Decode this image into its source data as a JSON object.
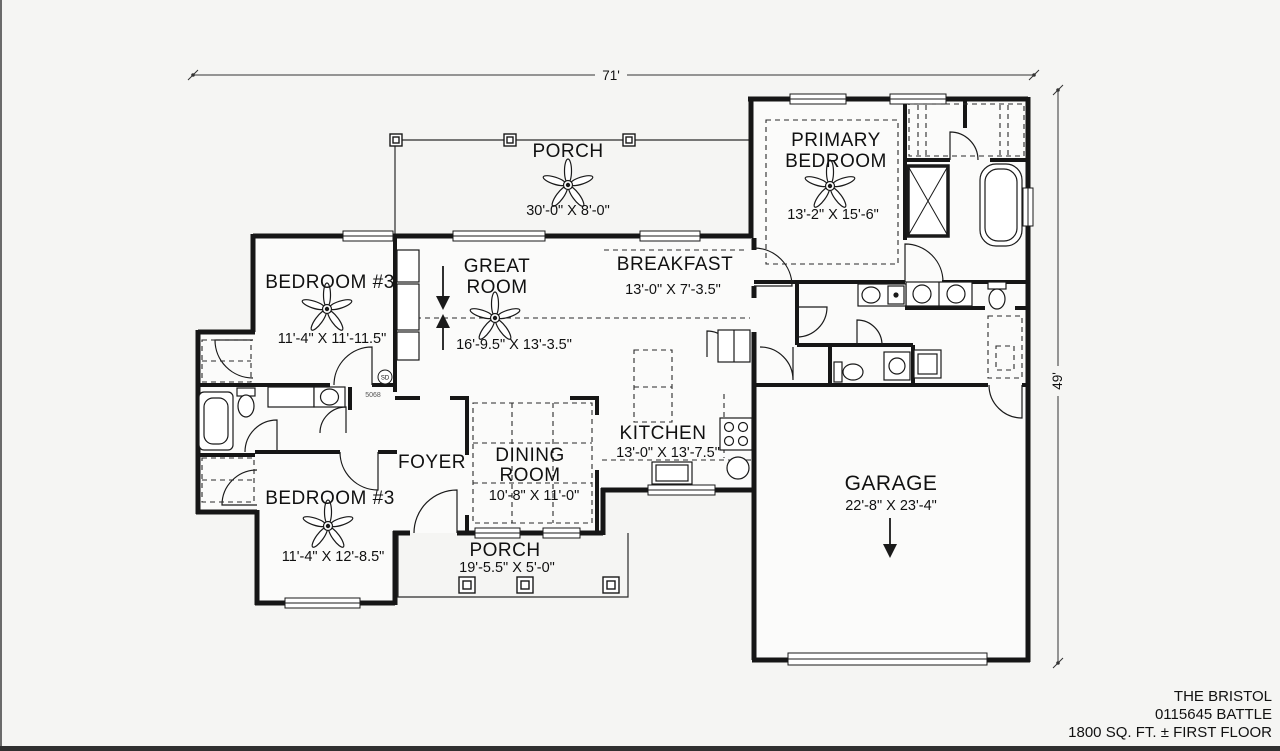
{
  "page": {
    "background": "#f5f5f3",
    "ink": "#1a1a1a"
  },
  "dimension_labels": {
    "top": "71'",
    "right": "49'"
  },
  "rooms": {
    "porch_top": {
      "name": "PORCH",
      "dims": "30'-0\" X 8'-0\""
    },
    "primary_bedroom": {
      "name1": "PRIMARY",
      "name2": "BEDROOM",
      "dims": "13'-2\" X 15'-6\""
    },
    "bedroom3_top": {
      "name": "BEDROOM #3",
      "dims": "11'-4\" X 11'-11.5\""
    },
    "great_room": {
      "name1": "GREAT",
      "name2": "ROOM",
      "dims": "16'-9.5\" X 13'-3.5\""
    },
    "breakfast": {
      "name": "BREAKFAST",
      "dims": "13'-0\" X 7'-3.5\""
    },
    "kitchen": {
      "name": "KITCHEN",
      "dims": "13'-0\" X 13'-7.5\""
    },
    "foyer": {
      "name": "FOYER"
    },
    "dining_room": {
      "name1": "DINING",
      "name2": "ROOM",
      "dims": "10'-8\" X 11'-0\""
    },
    "bedroom3_bottom": {
      "name": "BEDROOM #3",
      "dims": "11'-4\" X 12'-8.5\""
    },
    "porch_bottom": {
      "name": "PORCH",
      "dims": "19'-5.5\" X 5'-0\""
    },
    "garage": {
      "name": "GARAGE",
      "dims": "22'-8\" X 23'-4\""
    }
  },
  "annotations": {
    "smoke_detector": "SD",
    "door_tag": "5068"
  },
  "title_block": {
    "plan_name": "THE BRISTOL",
    "plan_number": "0115645 BATTLE",
    "area_line": "1800  SQ. FT. ± FIRST FLOOR"
  }
}
